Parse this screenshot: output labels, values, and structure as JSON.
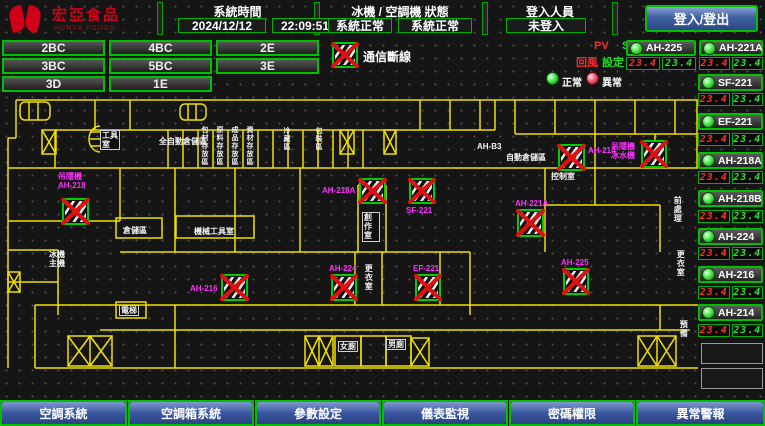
{
  "header": {
    "logo_title": "宏亞食品",
    "logo_subtitle": "HUNYA FOODS",
    "system_time_label": "系統時間",
    "date": "2024/12/12",
    "time": "22:09:51",
    "machine_status_label": "冰機 / 空調機 狀態",
    "chiller_status": "系統正常",
    "ac_status": "系統正常",
    "login_label": "登入人員",
    "login_status": "未登入",
    "login_button": "登入/登出"
  },
  "floor_buttons": [
    {
      "label": "2BC"
    },
    {
      "label": "4BC"
    },
    {
      "label": "2E"
    },
    {
      "label": "3BC"
    },
    {
      "label": "5BC"
    },
    {
      "label": "3E"
    },
    {
      "label": "3D"
    },
    {
      "label": "1E"
    }
  ],
  "legend": {
    "comm_loss": "通信斷線",
    "pv": "PV",
    "sv": "SV",
    "pv_desc": "回風",
    "sv_desc": "設定",
    "normal": "正常",
    "abnormal": "異常"
  },
  "units": [
    {
      "name": "AH-225",
      "pv": "23.4",
      "sv": "23.4",
      "status": "normal"
    },
    {
      "name": "AH-221A",
      "pv": "23.4",
      "sv": "23.4",
      "status": "normal"
    },
    {
      "name": "SF-221",
      "pv": "23.4",
      "sv": "23.4",
      "status": "normal"
    },
    {
      "name": "EF-221",
      "pv": "23.4",
      "sv": "23.4",
      "status": "normal"
    },
    {
      "name": "AH-218A",
      "pv": "23.4",
      "sv": "23.4",
      "status": "normal"
    },
    {
      "name": "AH-218B",
      "pv": "23.4",
      "sv": "23.4",
      "status": "normal"
    },
    {
      "name": "AH-224",
      "pv": "23.4",
      "sv": "23.4",
      "status": "normal"
    },
    {
      "name": "AH-216",
      "pv": "23.4",
      "sv": "23.4",
      "status": "normal"
    },
    {
      "name": "AH-214",
      "pv": "23.4",
      "sv": "23.4",
      "status": "normal"
    }
  ],
  "map": {
    "equipment": [
      {
        "label": "吊隱機 AH-218",
        "status": "通信斷線"
      },
      {
        "label": "AH-216",
        "status": "通信斷線"
      },
      {
        "label": "AH-218A",
        "status": "通信斷線"
      },
      {
        "label": "SF-221",
        "status": "通信斷線"
      },
      {
        "label": "AH-224",
        "status": "通信斷線"
      },
      {
        "label": "EF-221",
        "status": "通信斷線"
      },
      {
        "label": "AH-221A",
        "status": "通信斷線"
      },
      {
        "label": "AH-225",
        "status": "通信斷線"
      },
      {
        "label": "AH-214",
        "status": "通信斷線"
      },
      {
        "label": "吊隱機 冰水機",
        "status": "通信斷線"
      }
    ],
    "room_labels": [
      {
        "text": "工具室"
      },
      {
        "text": "全自動倉儲區"
      },
      {
        "text": "包材存放區"
      },
      {
        "text": "原料存放區"
      },
      {
        "text": "成品存放區"
      },
      {
        "text": "資材存放區"
      },
      {
        "text": "倉儲區"
      },
      {
        "text": "機械工具室"
      },
      {
        "text": "AH-B3"
      },
      {
        "text": "自動倉儲區"
      },
      {
        "text": "控制室"
      },
      {
        "text": "創作室"
      },
      {
        "text": "更衣室"
      },
      {
        "text": "冰機主機"
      },
      {
        "text": "電梯"
      },
      {
        "text": "女廁"
      },
      {
        "text": "男廁"
      },
      {
        "text": "前處理"
      },
      {
        "text": "更衣室"
      },
      {
        "text": "預備"
      },
      {
        "text": "冷藏區"
      },
      {
        "text": "包裝區"
      }
    ]
  },
  "bottom_nav": [
    {
      "label": "空調系統"
    },
    {
      "label": "空調箱系統"
    },
    {
      "label": "參數設定"
    },
    {
      "label": "儀表監視"
    },
    {
      "label": "密碼權限"
    },
    {
      "label": "異常警報"
    }
  ],
  "colors": {
    "wall_yellow": "#f0e000",
    "alarm_red": "#dd1111",
    "ok_green": "#00cc00",
    "magenta": "#ff30ff",
    "panel_blue": "#3a57a0",
    "seg_red": "#ff3222",
    "seg_green": "#28e228"
  }
}
